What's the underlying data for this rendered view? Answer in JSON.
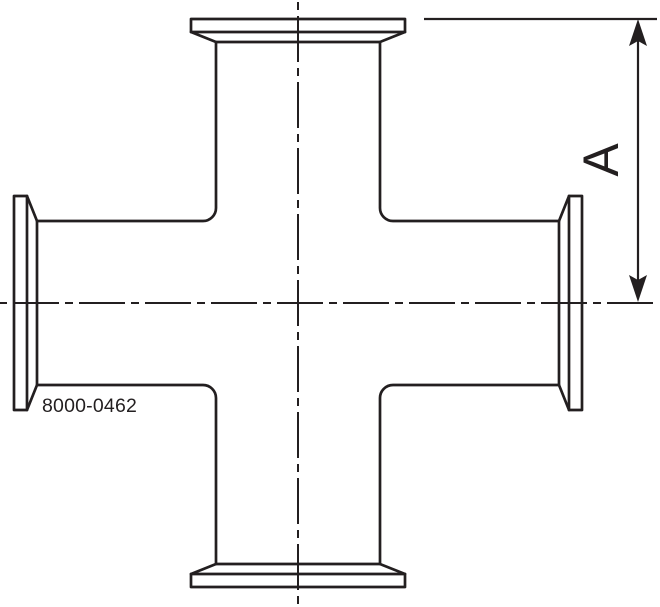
{
  "annotations": {
    "dimension_label": "A",
    "part_number": "8000-0462"
  },
  "colors": {
    "line": "#231f20",
    "background": "#ffffff"
  }
}
